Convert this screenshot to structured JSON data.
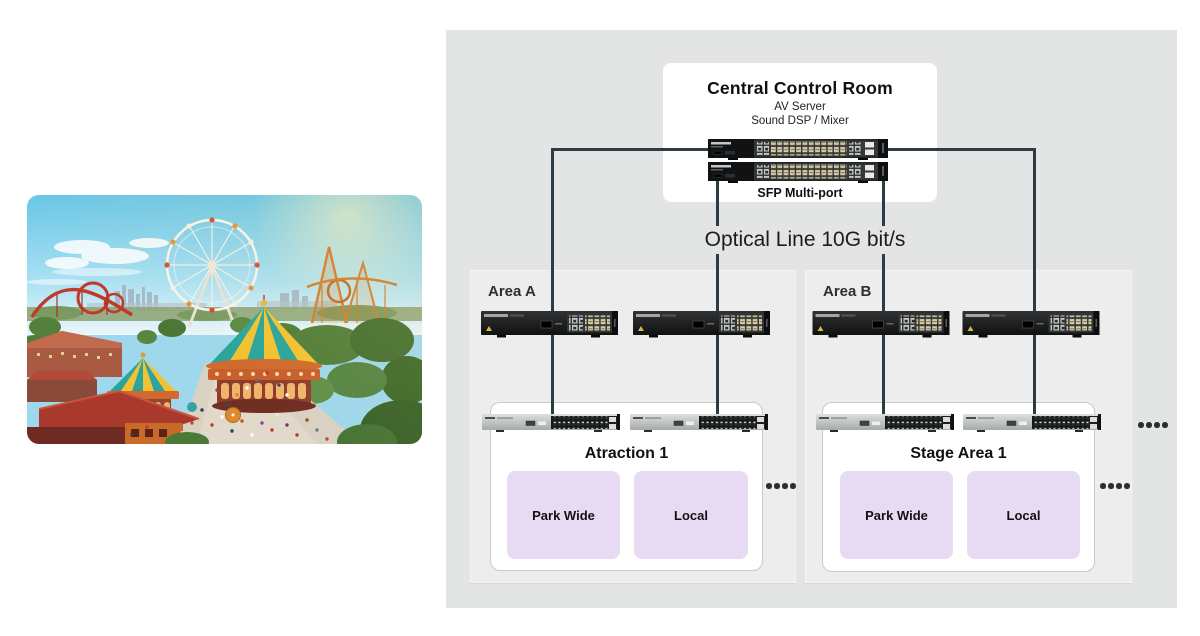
{
  "diagram": {
    "central_control_room": {
      "title": "Central Control Room",
      "items": [
        "AV Server",
        "Sound DSP / Mixer"
      ],
      "switch_label": "SFP Multi-port"
    },
    "optical_line_label": "Optical Line 10G bit/s",
    "areas": [
      {
        "title": "Area A",
        "unit": {
          "title": "Atraction 1",
          "zones": [
            "Park Wide",
            "Local"
          ]
        }
      },
      {
        "title": "Area B",
        "unit": {
          "title": "Stage Area 1",
          "zones": [
            "Park Wide",
            "Local"
          ]
        }
      }
    ],
    "colors": {
      "panel_bg": "#e3e4e4",
      "area_bg": "#ecedec",
      "unit_bg": "#ffffff",
      "zone_bg": "#e7dbf3",
      "line": "#2e3b42"
    }
  }
}
